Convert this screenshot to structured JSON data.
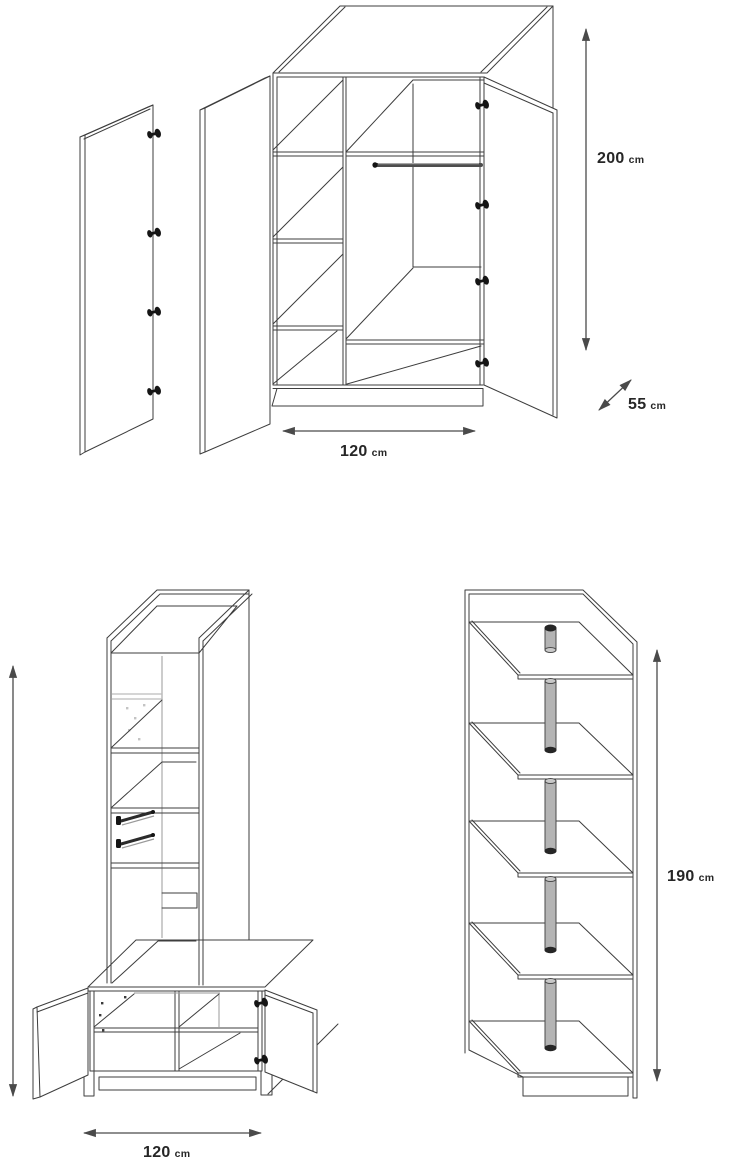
{
  "figures": {
    "wardrobe": {
      "height_label": {
        "value": "200",
        "unit": "cm"
      },
      "depth_label": {
        "value": "55",
        "unit": "cm"
      },
      "width_label": {
        "value": "120",
        "unit": "cm"
      }
    },
    "bench_unit": {
      "width_label": {
        "value": "120",
        "unit": "cm"
      }
    },
    "shelf_unit": {
      "height_label": {
        "value": "190",
        "unit": "cm"
      }
    }
  },
  "colors": {
    "background": "#ffffff",
    "line": "#3d3d3d",
    "dimension_line": "#4a4a4a",
    "label_text": "#262626",
    "hinge": "#151515",
    "pole_fill": "#b4b4b4",
    "pole_cap": "#262626",
    "glass_line": "#bcbcbc"
  }
}
